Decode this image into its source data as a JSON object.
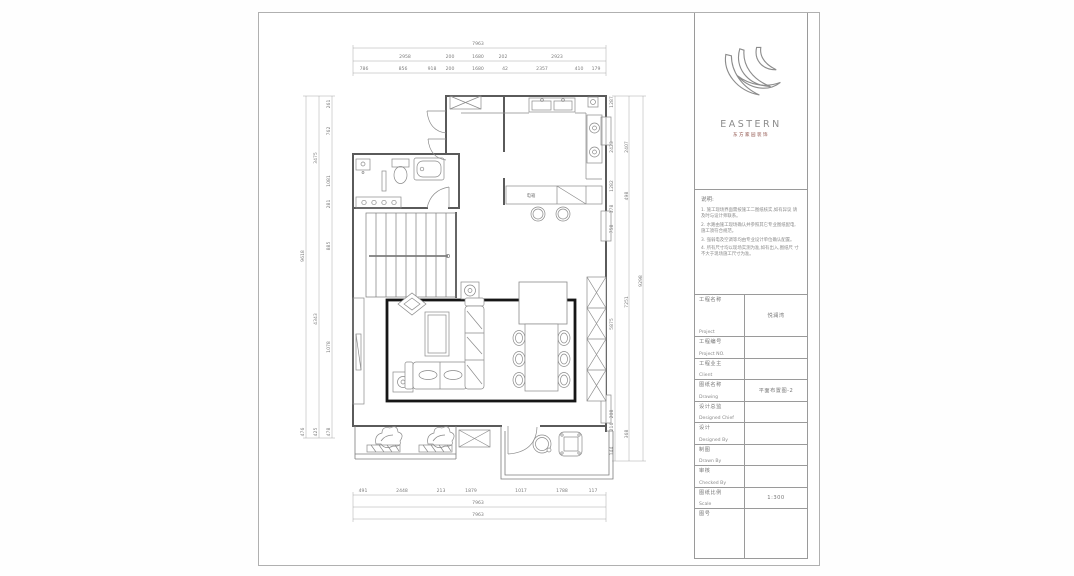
{
  "titleblock": {
    "logo_text": "EASTERN",
    "logo_sub": "东方家园装饰",
    "notes_title": "说明:",
    "notes": [
      "1. 施工现场界面需按施工二图纸核实,如有异议 请及时与设计师联系。",
      "2. 水路由施工现场确认并参照其它专业图纸配电, 施工须符合规范。",
      "3. 强弱电及空调等均由专业设计单位确认配置。",
      "4. 所有尺寸均以现场实测为准,如有出入,图纸尺 寸不大于现场施工尺寸为准。"
    ],
    "rows": [
      {
        "cn": "工程名称",
        "en": "Project",
        "value": "悦澜湾"
      },
      {
        "cn": "工程编号",
        "en": "Project NO.",
        "value": ""
      },
      {
        "cn": "工程业主",
        "en": "Client",
        "value": ""
      },
      {
        "cn": "图纸名称",
        "en": "Drawing",
        "value": "平面布置图-2"
      },
      {
        "cn": "设计总监",
        "en": "Designed Chief",
        "value": ""
      },
      {
        "cn": "设计",
        "en": "Designed By",
        "value": ""
      },
      {
        "cn": "制图",
        "en": "Drawn By",
        "value": ""
      },
      {
        "cn": "审核",
        "en": "Checked By",
        "value": ""
      },
      {
        "cn": "图纸比例",
        "en": "Scale",
        "value": "1:300"
      },
      {
        "cn": "图号",
        "en": "",
        "value": ""
      }
    ]
  },
  "plan": {
    "interior_labels": [
      {
        "t": "电箱",
        "x": 530,
        "y": 196
      }
    ],
    "dim_labels": [
      {
        "t": "7963",
        "x": 477,
        "y": 44
      },
      {
        "t": "2958",
        "x": 404,
        "y": 57
      },
      {
        "t": "200",
        "x": 449,
        "y": 57
      },
      {
        "t": "1680",
        "x": 477,
        "y": 57
      },
      {
        "t": "202",
        "x": 502,
        "y": 57
      },
      {
        "t": "2923",
        "x": 556,
        "y": 57
      },
      {
        "t": "786",
        "x": 363,
        "y": 69
      },
      {
        "t": "856",
        "x": 402,
        "y": 69
      },
      {
        "t": "918",
        "x": 431,
        "y": 69
      },
      {
        "t": "200",
        "x": 449,
        "y": 69
      },
      {
        "t": "1680",
        "x": 477,
        "y": 69
      },
      {
        "t": "42",
        "x": 504,
        "y": 69
      },
      {
        "t": "2357",
        "x": 541,
        "y": 69
      },
      {
        "t": "410",
        "x": 578,
        "y": 69
      },
      {
        "t": "179",
        "x": 595,
        "y": 69
      },
      {
        "t": "491",
        "x": 362,
        "y": 491
      },
      {
        "t": "2448",
        "x": 401,
        "y": 491
      },
      {
        "t": "213",
        "x": 440,
        "y": 491
      },
      {
        "t": "1879",
        "x": 470,
        "y": 491
      },
      {
        "t": "1017",
        "x": 520,
        "y": 491
      },
      {
        "t": "1788",
        "x": 561,
        "y": 491
      },
      {
        "t": "117",
        "x": 592,
        "y": 491
      },
      {
        "t": "7963",
        "x": 477,
        "y": 503
      },
      {
        "t": "7963",
        "x": 477,
        "y": 515
      },
      {
        "t": "9618",
        "x": 303,
        "y": 255,
        "r": -90
      },
      {
        "t": "3475",
        "x": 316,
        "y": 157,
        "r": -90
      },
      {
        "t": "4343",
        "x": 316,
        "y": 318,
        "r": -90
      },
      {
        "t": "425",
        "x": 316,
        "y": 431,
        "r": -90
      },
      {
        "t": "261",
        "x": 329,
        "y": 103,
        "r": -90
      },
      {
        "t": "762",
        "x": 329,
        "y": 130,
        "r": -90
      },
      {
        "t": "1081",
        "x": 329,
        "y": 180,
        "r": -90
      },
      {
        "t": "281",
        "x": 329,
        "y": 203,
        "r": -90
      },
      {
        "t": "885",
        "x": 329,
        "y": 245,
        "r": -90
      },
      {
        "t": "1078",
        "x": 329,
        "y": 346,
        "r": -90
      },
      {
        "t": "476",
        "x": 303,
        "y": 431,
        "r": -90
      },
      {
        "t": "478",
        "x": 329,
        "y": 431,
        "r": -90
      },
      {
        "t": "1287",
        "x": 612,
        "y": 101,
        "r": -90
      },
      {
        "t": "2423",
        "x": 612,
        "y": 146,
        "r": -90
      },
      {
        "t": "1282",
        "x": 612,
        "y": 185,
        "r": -90
      },
      {
        "t": "178",
        "x": 612,
        "y": 208,
        "r": -90
      },
      {
        "t": "758",
        "x": 612,
        "y": 228,
        "r": -90
      },
      {
        "t": "5875",
        "x": 612,
        "y": 323,
        "r": -90
      },
      {
        "t": "208",
        "x": 612,
        "y": 413,
        "r": -90
      },
      {
        "t": "216",
        "x": 612,
        "y": 426,
        "r": -90
      },
      {
        "t": "144",
        "x": 612,
        "y": 450,
        "r": -90
      },
      {
        "t": "2407",
        "x": 627,
        "y": 146,
        "r": -90
      },
      {
        "t": "498",
        "x": 627,
        "y": 195,
        "r": -90
      },
      {
        "t": "7251",
        "x": 627,
        "y": 301,
        "r": -90
      },
      {
        "t": "368",
        "x": 627,
        "y": 433,
        "r": -90
      },
      {
        "t": "9298",
        "x": 641,
        "y": 280,
        "r": -90
      }
    ]
  }
}
